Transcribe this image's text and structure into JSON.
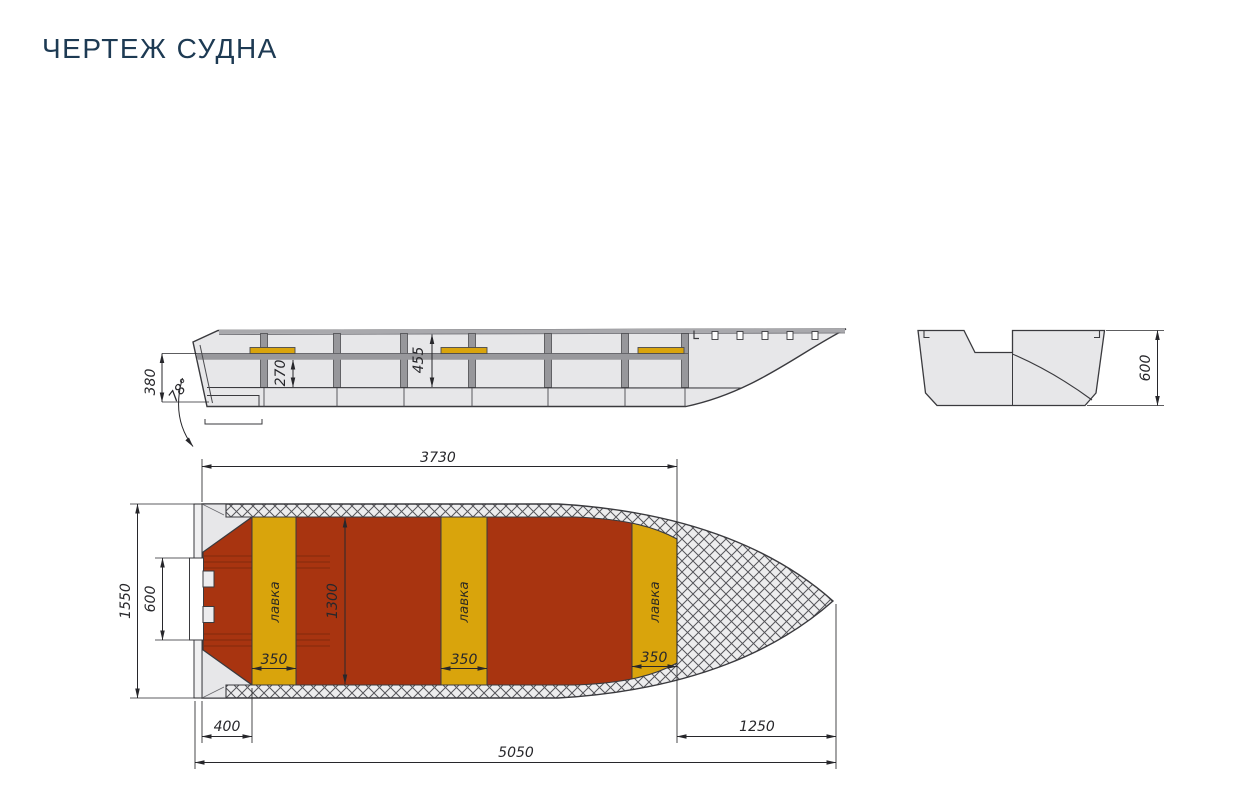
{
  "title": "ЧЕРТЕЖ СУДНА",
  "colors": {
    "title": "#1d3a53",
    "deck_red": "#a83410",
    "bench_yellow": "#d9a40c",
    "hull_gray": "#e7e7e9",
    "frame_gray": "#97979b",
    "outline": "#3a3a3e",
    "dim": "#27272b"
  },
  "side_view": {
    "dims": {
      "transom_height": "380",
      "transom_angle": "78°",
      "inner_depth": "270",
      "mid_depth": "455"
    }
  },
  "section_view": {
    "dims": {
      "height": "600"
    }
  },
  "plan_view": {
    "bench_label": "лавка",
    "dims": {
      "cockpit_length": "3730",
      "beam": "1550",
      "transom_recess": "600",
      "cockpit_width": "1300",
      "bench_width": "350",
      "stern_offset": "400",
      "bow_length": "1250",
      "overall_length": "5050"
    }
  }
}
